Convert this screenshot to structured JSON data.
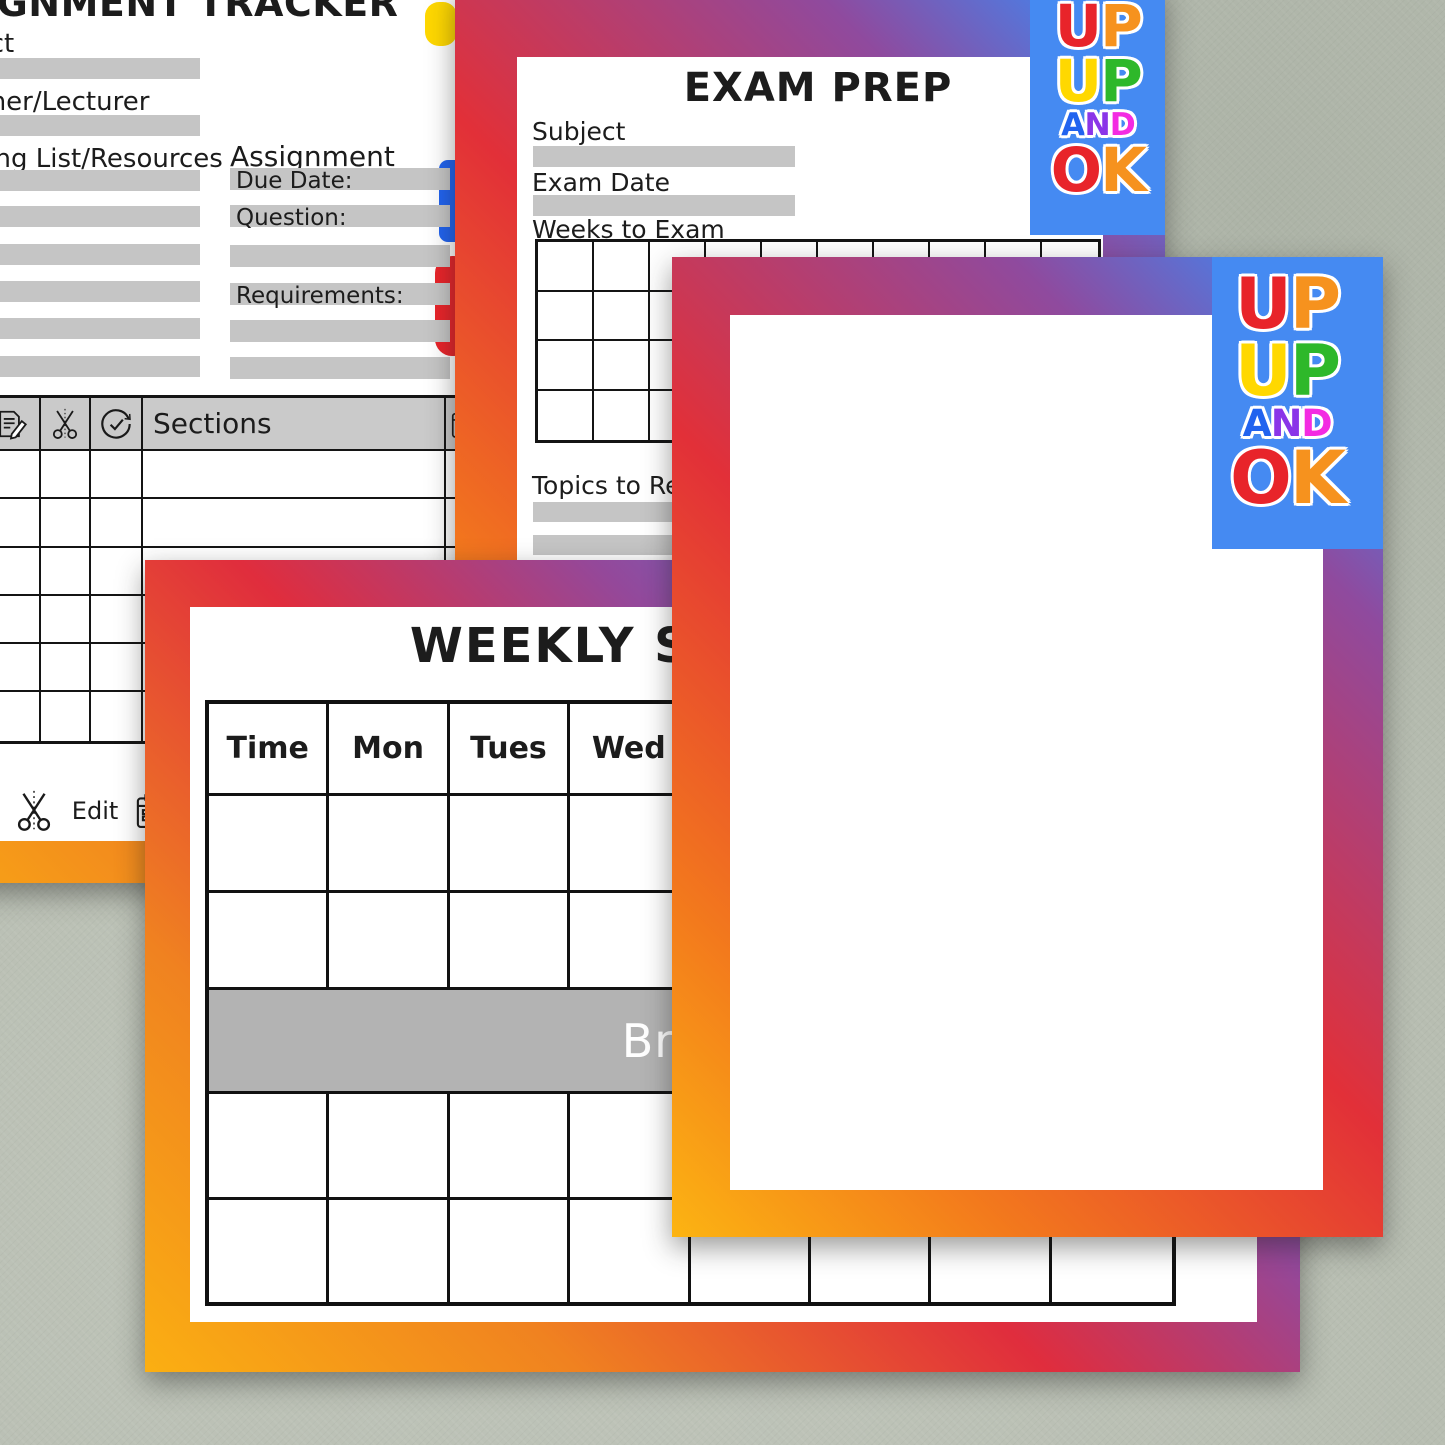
{
  "colors": {
    "background": "#b7bdb1",
    "page_border_gradient": [
      "#fcb412",
      "#f37a1c",
      "#e23038",
      "#8f4a9e",
      "#4086f0"
    ],
    "field_bar_gray": "#c5c5c5",
    "table_header_gray": "#cacaca",
    "break_band_gray": "#b3b3b3",
    "break_text_white": "#ffffff",
    "logo_patch_blue": "#458af2",
    "ink_black": "#1c1c1c"
  },
  "logo": {
    "name": "UP UP AND OK",
    "rows": [
      [
        {
          "ch": "U",
          "color": "#e8242a"
        },
        {
          "ch": "P",
          "color": "#f6921e"
        }
      ],
      [
        {
          "ch": "U",
          "color": "#ffd800"
        },
        {
          "ch": "P",
          "color": "#2eb82a"
        }
      ],
      [
        {
          "ch": "A",
          "color": "#2163ef"
        },
        {
          "ch": "N",
          "color": "#8a35e8"
        },
        {
          "ch": "D",
          "color": "#f32be2"
        }
      ],
      [
        {
          "ch": "O",
          "color": "#e8242a"
        },
        {
          "ch": "K",
          "color": "#f6921e"
        }
      ]
    ]
  },
  "assignment_page": {
    "title": "ASSIGNMENT TRACKER",
    "subject_label": "Subject",
    "teacher_label": "Teacher/Lecturer",
    "reading_label": "Reading List/Resources",
    "assignment_heading": "Assignment",
    "due_date_label": "Due Date:",
    "question_label": "Question:",
    "requirements_label": "Requirements:",
    "sections_header": "Sections",
    "header_icons": [
      "document-edit-icon",
      "scissors-icon",
      "check-circle-icon",
      "calendar-icon"
    ],
    "table_rows": 6,
    "legend": {
      "idea_label": "Idea",
      "edit_label": "Edit"
    }
  },
  "exam_page": {
    "title": "EXAM PREP",
    "subject_label": "Subject",
    "exam_date_label": "Exam Date",
    "weeks_label": "Weeks to Exam",
    "topics_label": "Topics to Revise",
    "weeks_grid": {
      "rows": 4,
      "cols": 10
    }
  },
  "weekly_page": {
    "title": "WEEKLY SCHEDULE",
    "columns": [
      "Time",
      "Mon",
      "Tues",
      "Wed"
    ],
    "break_label": "Break"
  }
}
